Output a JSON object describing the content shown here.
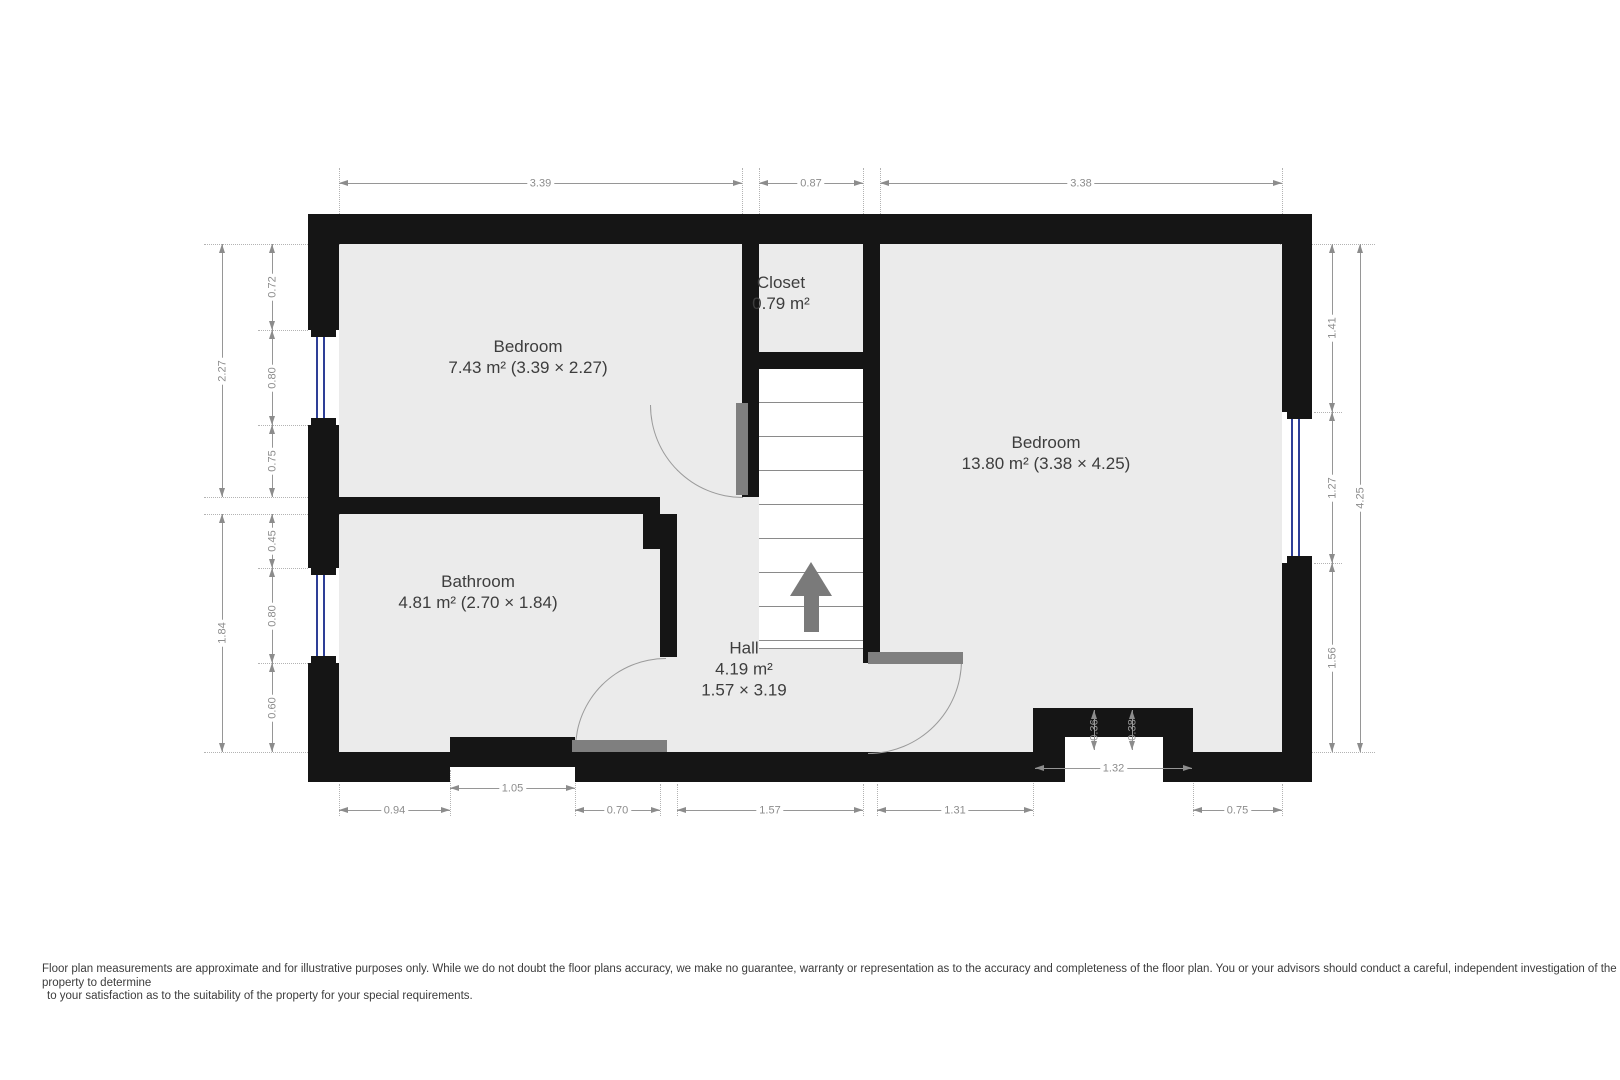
{
  "title": "Floor plan",
  "rooms": [
    {
      "name": "Bedroom",
      "area": "7.43 m² (3.39 × 2.27)"
    },
    {
      "name": "Closet",
      "area": "0.79 m²"
    },
    {
      "name": "Bedroom",
      "area": "13.80 m² (3.38 × 4.25)"
    },
    {
      "name": "Bathroom",
      "area": "4.81 m² (2.70 × 1.84)"
    },
    {
      "name": "Hall",
      "area": "4.19 m²",
      "dims": "1.57 × 3.19"
    }
  ],
  "dimensions": {
    "top": [
      "3.39",
      "0.87",
      "3.38"
    ],
    "left_outer": [
      "2.27",
      "1.84"
    ],
    "left_inner": [
      "0.72",
      "0.80",
      "0.75",
      "0.45",
      "0.80",
      "0.60"
    ],
    "right_inner": [
      "1.41",
      "1.27",
      "1.56"
    ],
    "right_outer": [
      "4.25"
    ],
    "bottom_row": [
      "0.94",
      "0.70",
      "1.57",
      "1.31",
      "0.75"
    ],
    "bottom_notch": "1.05",
    "chimney_width": "1.32",
    "chimney_depths": [
      "0.36",
      "0.38"
    ]
  },
  "stairs": {
    "direction": "up"
  },
  "colors": {
    "wall": "#151515",
    "floor": "#ebebeb",
    "window_glass": "#2e3f97",
    "door_leaf": "#7f7f7f",
    "dimension_text": "#8c8c8c"
  },
  "disclaimer": {
    "line1": "Floor plan measurements are approximate and for illustrative purposes only. While we do not doubt the floor plans accuracy, we make no guarantee, warranty or representation as to the accuracy and completeness of the floor plan. You or your advisors should conduct a careful, independent investigation of the",
    "line2": "property to determine",
    "line3": "to your satisfaction as to the suitability of the property for your special requirements."
  }
}
